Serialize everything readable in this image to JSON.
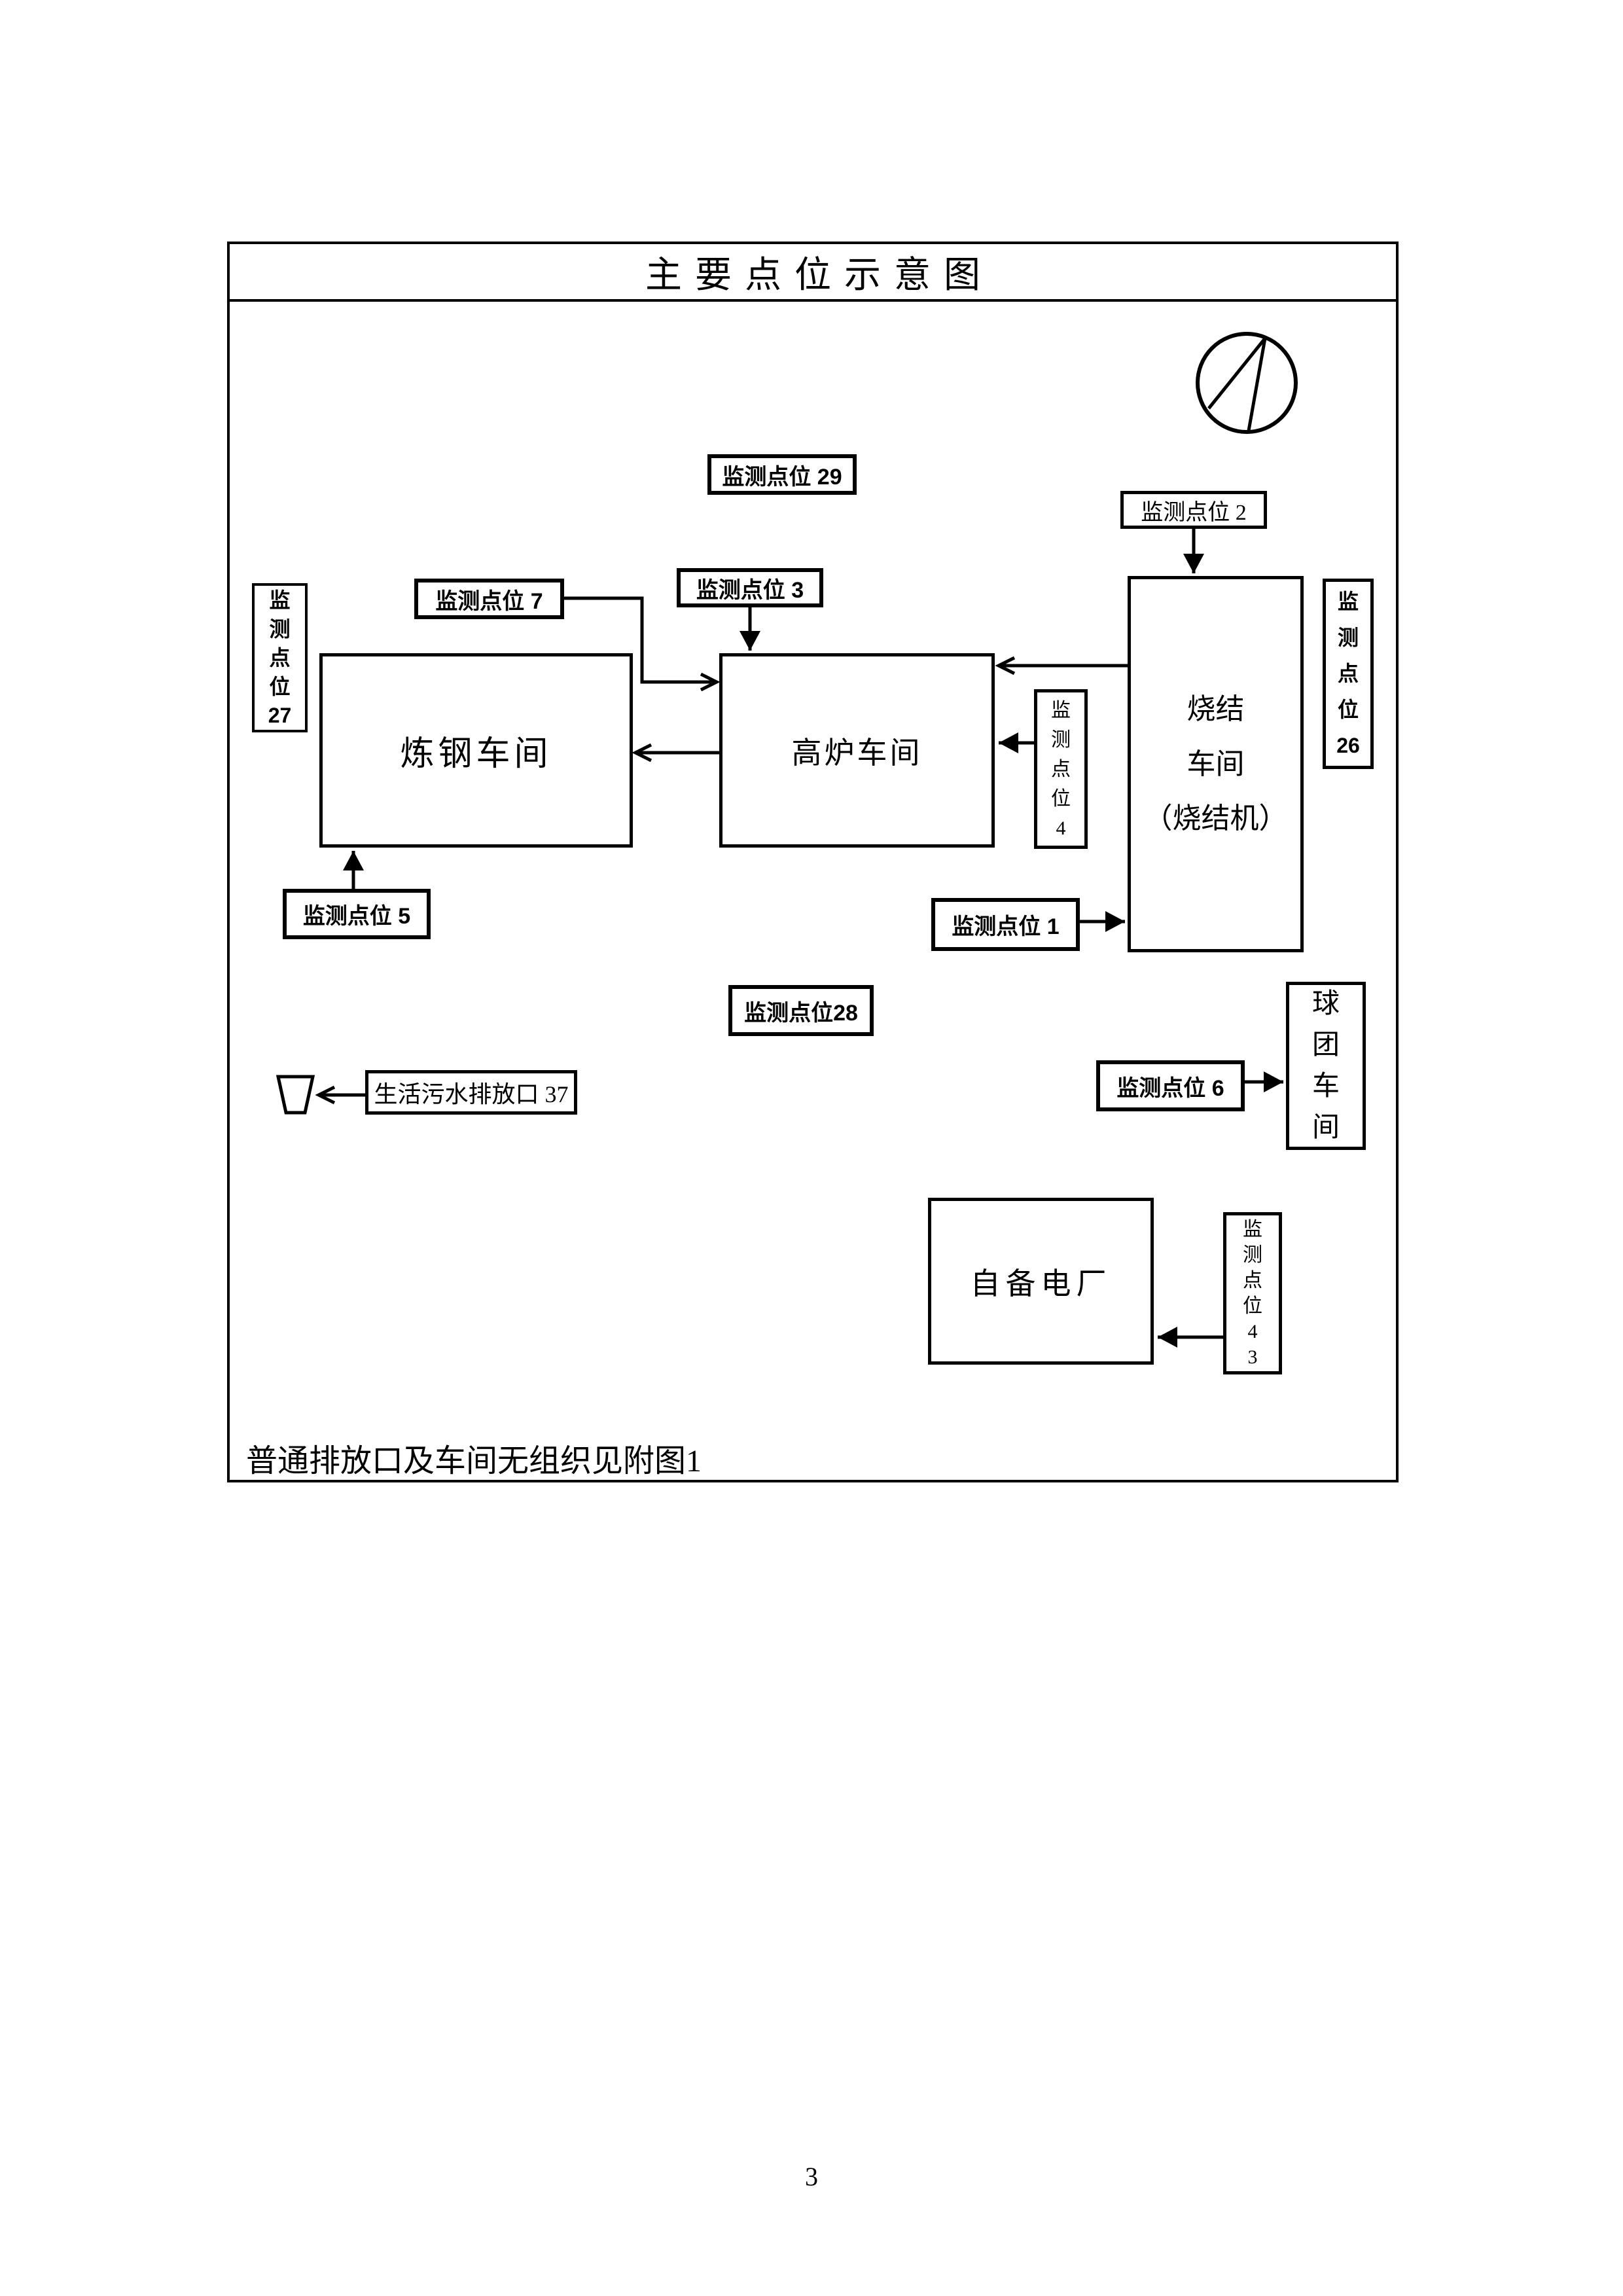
{
  "page": {
    "title": "主要点位示意图",
    "footnote": "普通排放口及车间无组织见附图1",
    "page_number": "3"
  },
  "workshops": {
    "steelmaking": "炼钢车间",
    "blast_furnace": "高炉车间",
    "sintering": "烧结\n车间\n（烧结机）",
    "pellet": "球\n团\n车\n间",
    "power_plant": "自备电厂"
  },
  "monitoring_points": {
    "mp29": "监测点位 29",
    "mp2": "监测点位 2",
    "mp7": "监测点位 7",
    "mp3": "监测点位 3",
    "mp27": "监\n测\n点\n位\n27",
    "mp26": "监\n测\n点\n位\n26",
    "mp4": "监\n测\n点\n位\n4",
    "mp5": "监测点位 5",
    "mp1": "监测点位 1",
    "mp28": "监测点位28",
    "mp6": "监测点位 6",
    "mp43": "监\n测\n点\n位\n4\n3",
    "sewage_outlet": "生活污水排放口 37"
  },
  "icons": {
    "north_symbol": "compass-north-circle",
    "outfall_symbol": "sewage-outfall-funnel"
  },
  "colors": {
    "ink": "#000000",
    "paper": "#ffffff"
  }
}
